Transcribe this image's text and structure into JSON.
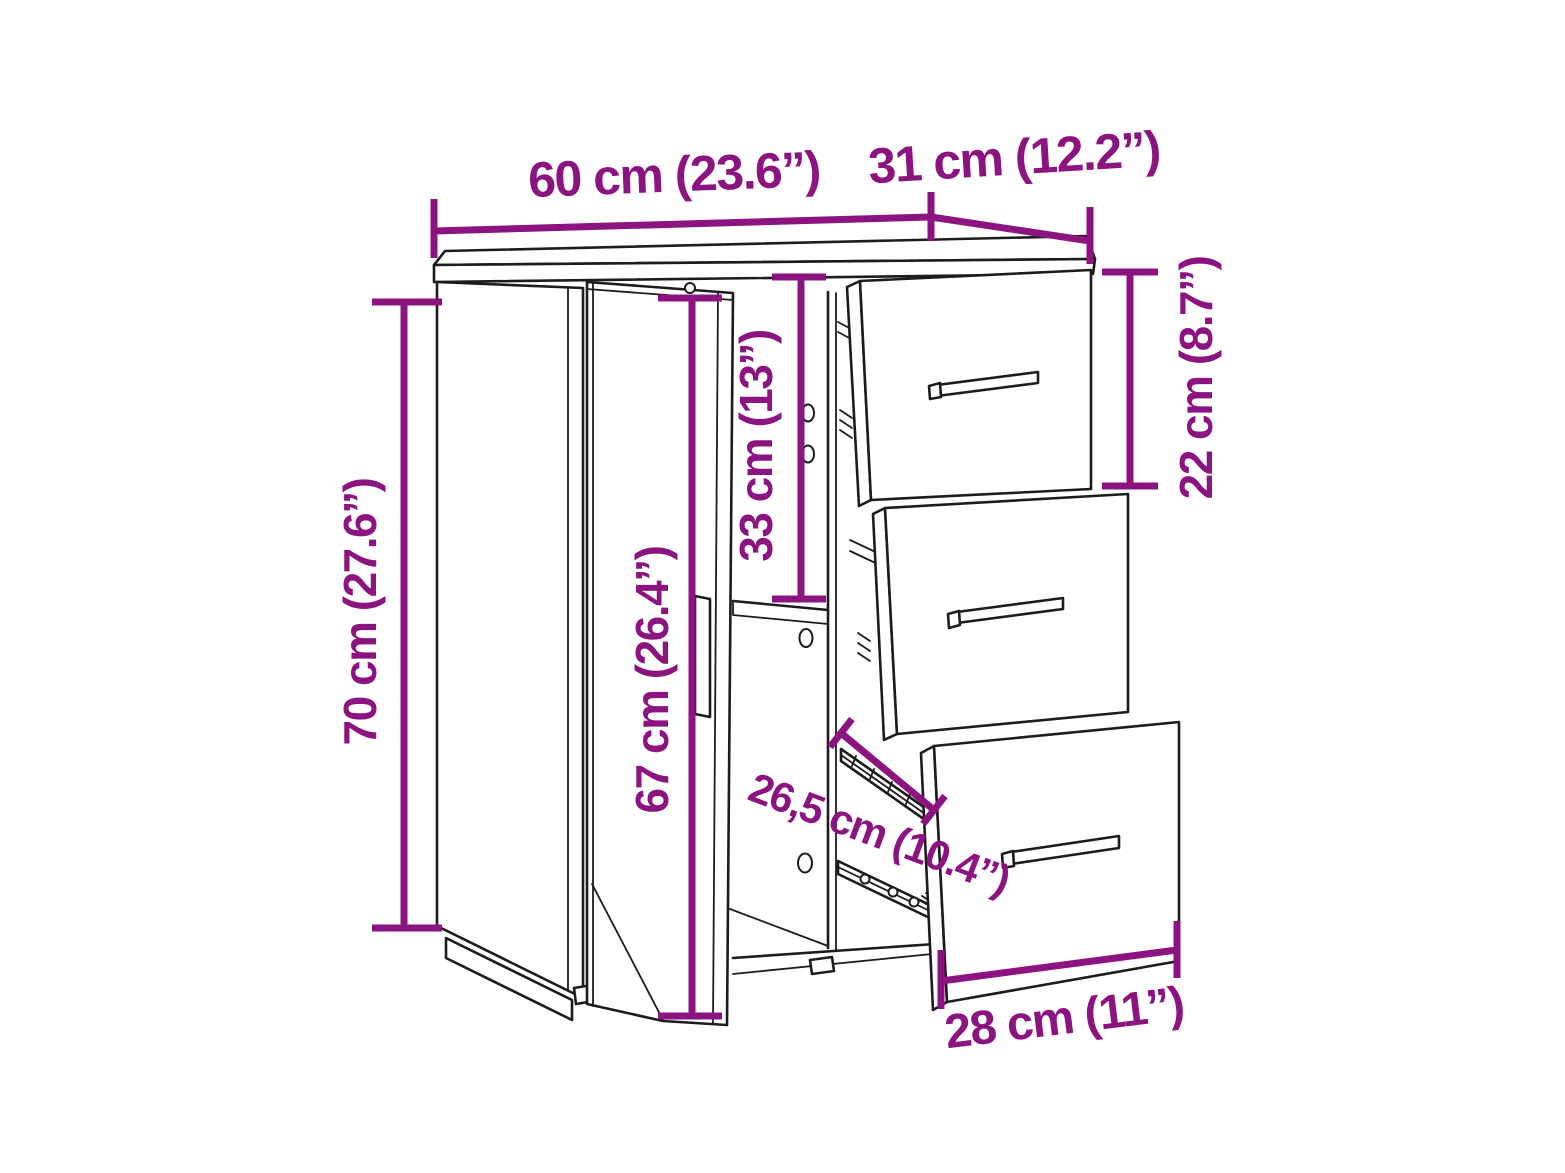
{
  "diagram": {
    "subject": "Sideboard cabinet with one open door and three pull-out drawers — dimension line drawing",
    "colors": {
      "dimension_accent": "#8C1480",
      "outline": "#1C1C1C",
      "background": "#FFFFFF"
    },
    "dims": {
      "width": {
        "label": "60 cm (23.6”)",
        "cm": 60,
        "inches": 23.6
      },
      "depth": {
        "label": "31 cm (12.2”)",
        "cm": 31,
        "inches": 12.2
      },
      "height": {
        "label": "70 cm (27.6”)",
        "cm": 70,
        "inches": 27.6
      },
      "door_height": {
        "label": "67 cm (26.4”)",
        "cm": 67,
        "inches": 26.4
      },
      "compartment_height": {
        "label": "33 cm (13”)",
        "cm": 33,
        "inches": 13
      },
      "drawer_front_height": {
        "label": "22 cm (8.7”)",
        "cm": 22,
        "inches": 8.7
      },
      "drawer_depth": {
        "label": "26,5 cm (10.4”)",
        "cm": 26.5,
        "inches": 10.4
      },
      "drawer_front_width": {
        "label": "28 cm (11”)",
        "cm": 28,
        "inches": 11
      }
    }
  }
}
